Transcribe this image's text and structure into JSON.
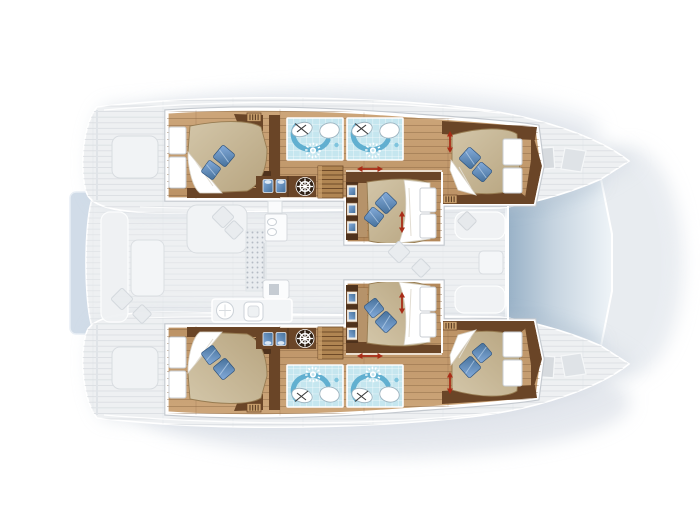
{
  "title": "Catamaran interior layout plan — top view, bow right, 6 cabins",
  "colors": {
    "wood": "#cda67a",
    "wood_dark": "#b3885a",
    "wall": "#6a4527",
    "wall_dark": "#4f321c",
    "headboard": "#b6936a",
    "bed": "#d3c6a9",
    "bed_dark": "#b7a47f",
    "pillow": "#85acdb",
    "pillow_dark": "#46719b",
    "tile": "#c5e6ef",
    "tile_arc": "#55a9cc",
    "deck": "#eef0f2",
    "platform": "#cdd9e6",
    "tramp_dark": "#97b0c6",
    "tramp_light": "#eff4f8",
    "arrow": "#a82c17",
    "icon_bg": "#2f2014",
    "shadow": "#c8cfda"
  },
  "plan": {
    "view": "top-down",
    "orientation": "bow-right",
    "hulls": [
      "port",
      "starboard"
    ],
    "cabins": [
      {
        "name": "port-aft-cabin",
        "bed": "double",
        "pillows": 2
      },
      {
        "name": "port-forward-cabin",
        "bed": "double",
        "pillows": 2
      },
      {
        "name": "center-port-cabin",
        "bed": "double",
        "pillows": 2
      },
      {
        "name": "center-starboard-cabin",
        "bed": "double",
        "pillows": 2
      },
      {
        "name": "starboard-aft-cabin",
        "bed": "double",
        "pillows": 2
      },
      {
        "name": "starboard-forward-cabin",
        "bed": "double",
        "pillows": 2
      }
    ],
    "bathrooms": [
      {
        "name": "port-head-1",
        "fixtures": [
          "shower",
          "washbasin",
          "toilet"
        ]
      },
      {
        "name": "port-head-2",
        "fixtures": [
          "shower",
          "washbasin",
          "toilet"
        ]
      },
      {
        "name": "starboard-head-1",
        "fixtures": [
          "shower",
          "washbasin",
          "toilet"
        ]
      },
      {
        "name": "starboard-head-2",
        "fixtures": [
          "shower",
          "washbasin",
          "toilet"
        ]
      }
    ],
    "icons": [
      "ship-wheel",
      "shower-rose",
      "companionway-stairs",
      "direction-arrow",
      "vent-grille"
    ],
    "areas": {
      "highlighted": [
        "hull cabins",
        "heads",
        "center cabins",
        "companionways"
      ],
      "faded": [
        "aft cockpit",
        "saloon",
        "galley",
        "forward cockpit",
        "bow decks",
        "helm seat",
        "swim platform"
      ]
    },
    "trampoline": true
  }
}
